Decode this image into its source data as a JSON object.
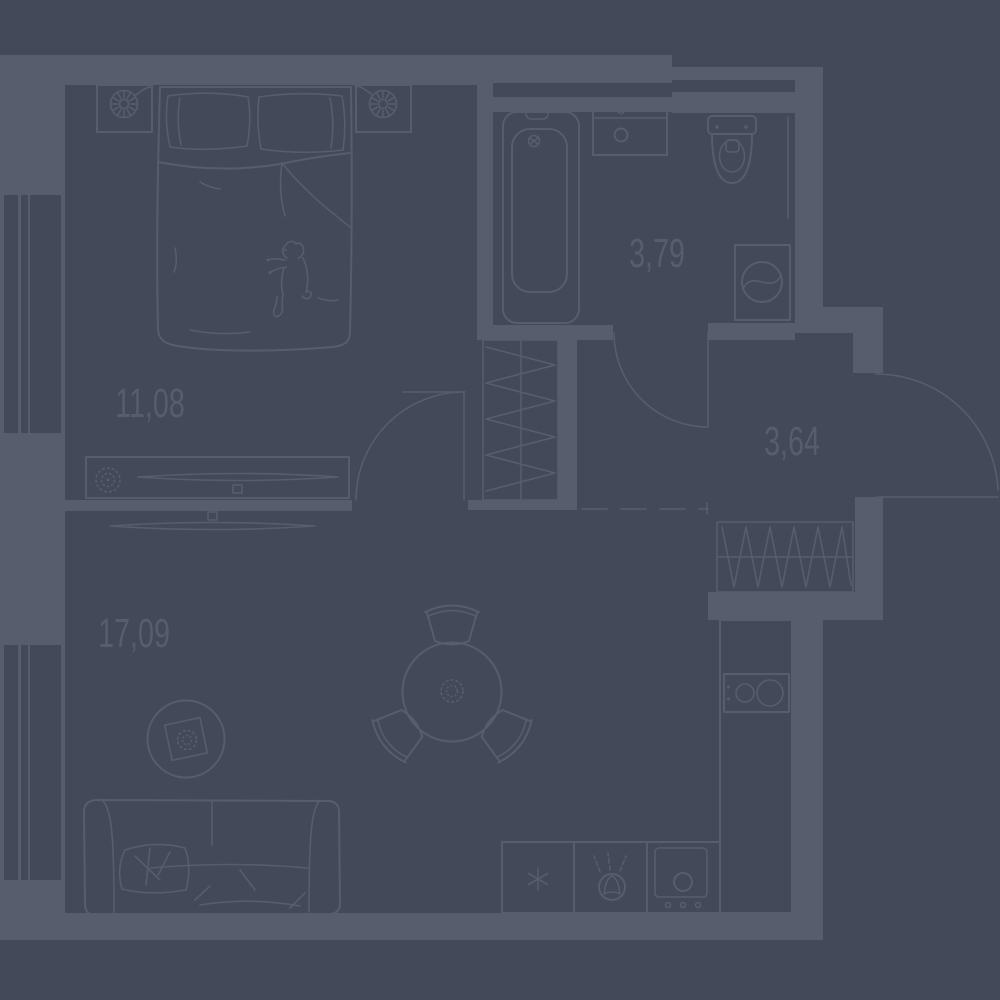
{
  "title": "apartment-floor-plan",
  "colors": {
    "background": "#434959",
    "walls": "#575d6c",
    "lines": "#575d6c",
    "text": "#575d6c"
  },
  "rooms": {
    "bedroom": {
      "area_label": "11,08",
      "furniture": [
        "double-bed",
        "pillows",
        "blanket-with-dog-print",
        "nightstand-left",
        "nightstand-right",
        "clock-starburst",
        "dresser",
        "tv-on-dresser",
        "plant-pot",
        "window"
      ]
    },
    "bathroom": {
      "area_label": "3,79",
      "furniture": [
        "bathtub",
        "washbasin",
        "toilet",
        "washing-machine",
        "door-swing"
      ]
    },
    "hallway": {
      "area_label": "3,64",
      "furniture": [
        "wardrobe-hatched",
        "entrance-door-swing",
        "ventilation-shaft"
      ]
    },
    "living_kitchen": {
      "area_label": "17,09",
      "furniture": [
        "sofa",
        "wall-tv",
        "round-dining-table",
        "chairs-x3",
        "round-rug-with-plant",
        "kitchen-counter",
        "hob-2-burners",
        "fridge-snowflake",
        "kitchen-sink",
        "oven",
        "window"
      ]
    }
  }
}
